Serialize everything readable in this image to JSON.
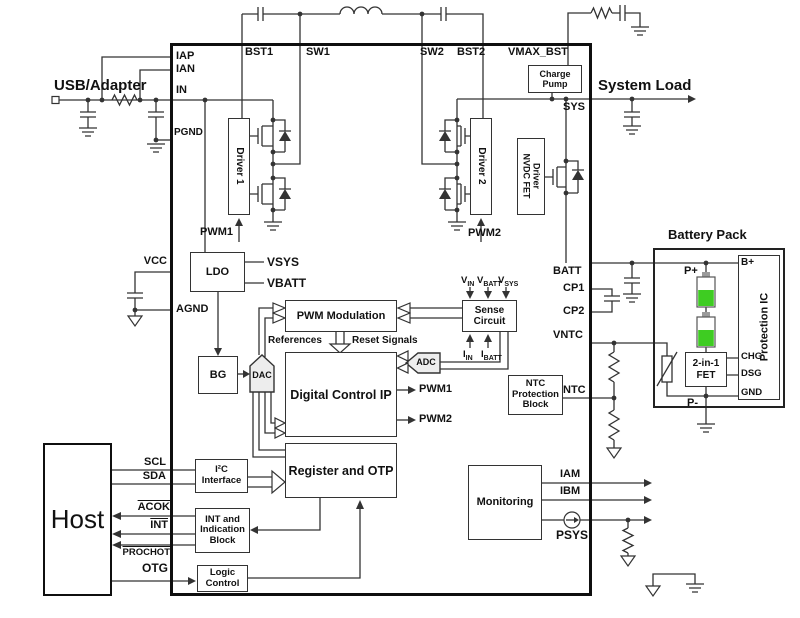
{
  "diagram": {
    "external": {
      "usb_adapter": "USB/Adapter",
      "system_load": "System Load",
      "host": "Host",
      "battery_pack": "Battery Pack"
    },
    "pins": {
      "top": [
        "BST1",
        "SW1",
        "SW2",
        "BST2",
        "VMAX_BST"
      ],
      "left": [
        "IAP",
        "IAN",
        "IN",
        "PGND",
        "VCC",
        "AGND",
        "SCL",
        "SDA",
        "ACOK",
        "INT",
        "PROCHOT",
        "OTG"
      ],
      "right": [
        "SYS",
        "BATT",
        "CP1",
        "CP2",
        "VNTC",
        "NTC",
        "IAM",
        "IBM",
        "PSYS"
      ]
    },
    "blocks": {
      "driver1": "Driver 1",
      "driver2": "Driver 2",
      "charge_pump_l1": "Charge",
      "charge_pump_l2": "Pump",
      "nvdc_l1": "NVDC FET",
      "nvdc_l2": "Driver",
      "ldo": "LDO",
      "bg": "BG",
      "dac": "DAC",
      "adc": "ADC",
      "pwm_modulation": "PWM Modulation",
      "sense_l1": "Sense",
      "sense_l2": "Circuit",
      "dcip": "Digital Control IP",
      "register": "Register and OTP",
      "i2c_l1": "I²C",
      "i2c_l2": "Interface",
      "int_l1": "INT and",
      "int_l2": "Indication",
      "int_l3": "Block",
      "logic_l1": "Logic",
      "logic_l2": "Control",
      "monitoring": "Monitoring",
      "ntc_l1": "NTC",
      "ntc_l2": "Protection",
      "ntc_l3": "Block"
    },
    "signals": {
      "pwm1": "PWM1",
      "pwm2": "PWM2",
      "vsys": "VSYS",
      "vbatt": "VBATT",
      "references": "References",
      "reset_signals": "Reset Signals"
    },
    "sense_inputs": {
      "vin": {
        "b": "V",
        "s": "IN"
      },
      "vbatt": {
        "b": "V",
        "s": "BATT"
      },
      "vsys": {
        "b": "V",
        "s": "SYS"
      },
      "iin": {
        "b": "I",
        "s": "IN"
      },
      "ibatt": {
        "b": "I",
        "s": "BATT"
      }
    },
    "battery": {
      "p_plus": "P+",
      "p_minus": "P-",
      "b_plus": "B+",
      "chg": "CHG",
      "dsg": "DSG",
      "gnd": "GND",
      "fet_l1": "2-in-1",
      "fet_l2": "FET",
      "protection_ic": "Protection IC"
    },
    "colors": {
      "line": "#333333",
      "battery_green": "#3ecc22",
      "mux_fill": "#ededed"
    }
  }
}
